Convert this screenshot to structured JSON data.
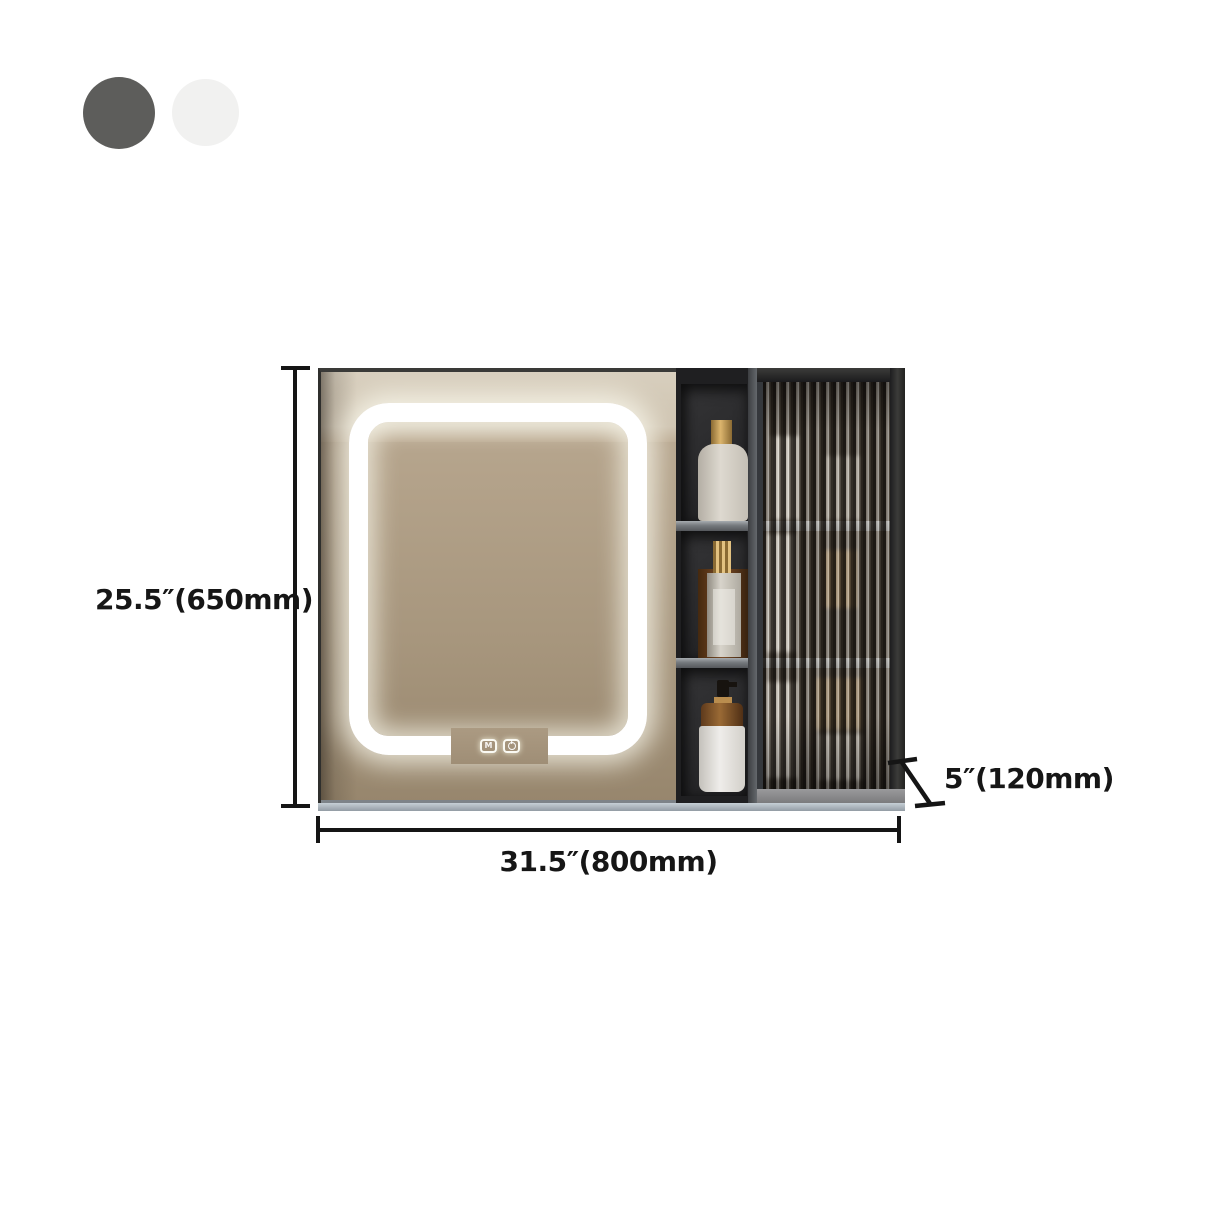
{
  "color_swatches": {
    "items": [
      {
        "name": "dark-gray",
        "color": "#5d5d5b"
      },
      {
        "name": "white",
        "color": "#f1f1f0"
      }
    ]
  },
  "product": {
    "dimensions": {
      "height": "25.5″(650mm)",
      "width": "31.5″(800mm)",
      "depth": "5″(120mm)"
    },
    "image": {
      "icons": [
        "led-light-ring",
        "light-mode-touch-icon",
        "power-touch-icon",
        "cosmetic-bottle-icon",
        "perfume-bottle-icon",
        "pump-bottle-icon",
        "fluted-glass-door",
        "open-shelf-column"
      ],
      "colors": {
        "mirror_reflection": "#ab9a81",
        "led_light": "#ffffff",
        "cabinet_body": "#232326",
        "shelf_board": "#75797d",
        "glass_tint": "#3a342d",
        "dimension_line": "#151515"
      }
    }
  }
}
